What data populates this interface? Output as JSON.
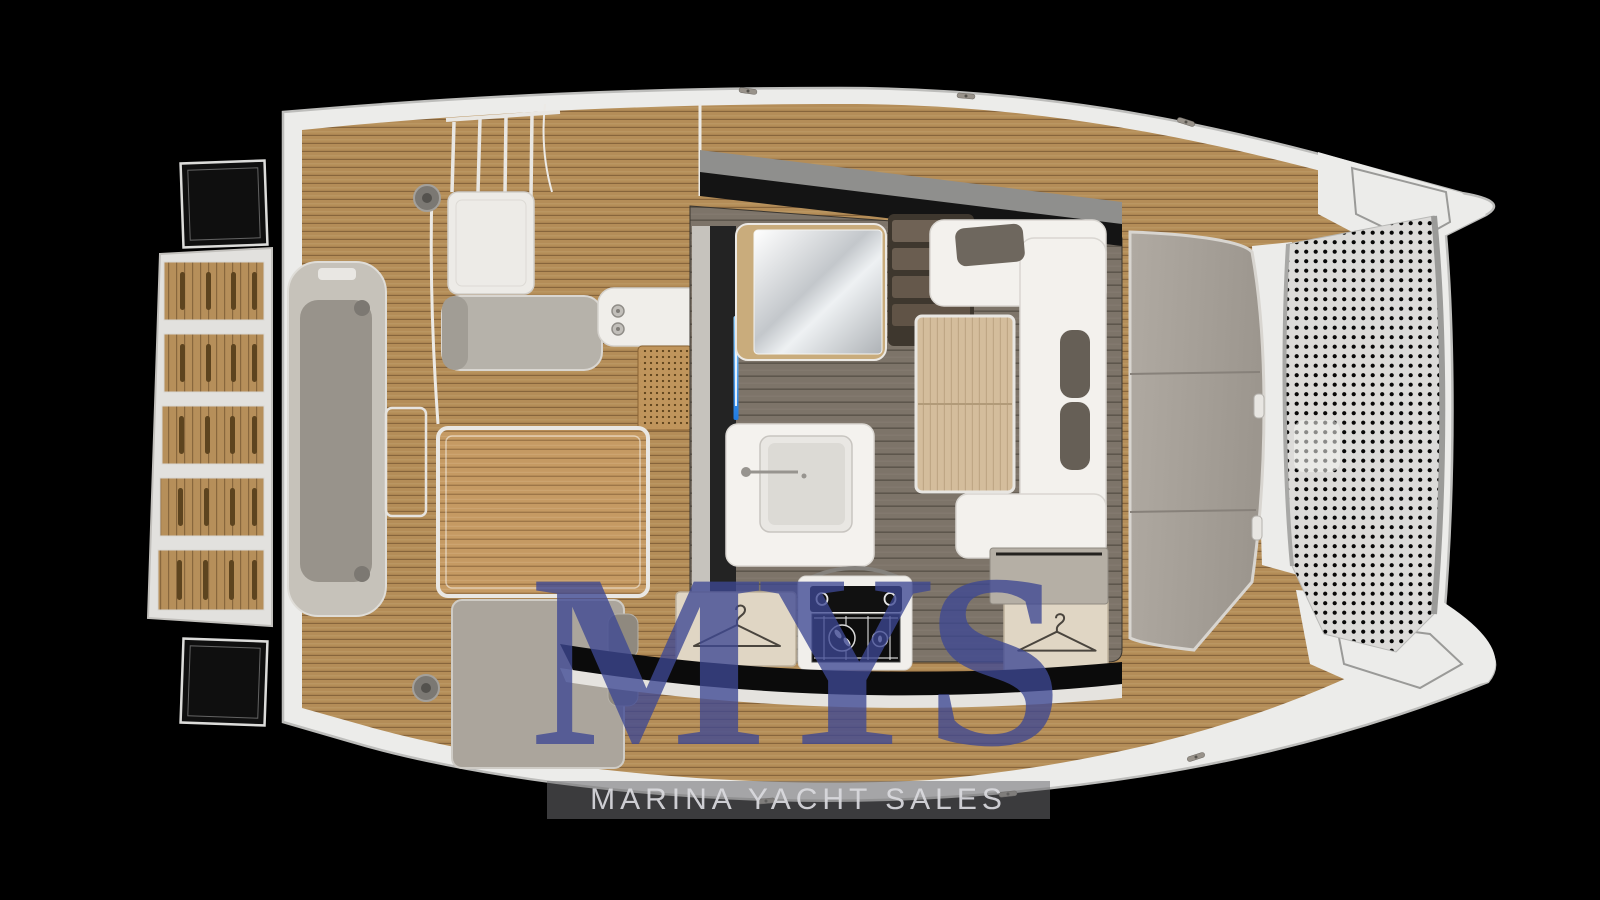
{
  "watermark": {
    "logo": "MYS",
    "tagline": "MARINA YACHT SALES"
  },
  "palette": {
    "background": "#000000",
    "hull_white": "#ececea",
    "hull_outline": "#bdbdbb",
    "teak_deck": "#b48d58",
    "cockpit_table_wood": "#c59a63",
    "saloon_floor": "#7d7469",
    "saloon_table_wood": "#d4bd9c",
    "foredeck_pads": "#a8a29a",
    "trampoline_mesh": "#dcdbd9",
    "trampoline_dots": "#070707",
    "sofa_white": "#f3f1ed",
    "cushion_gray": "#6e675e",
    "mirror_frame_wood": "#c9ac7c",
    "led_accent_blue": "#2e9bff",
    "watermark_blue": "#3e488f",
    "tagline_band_gray": "#6c6c70",
    "tagline_text_gray": "#dadade"
  }
}
